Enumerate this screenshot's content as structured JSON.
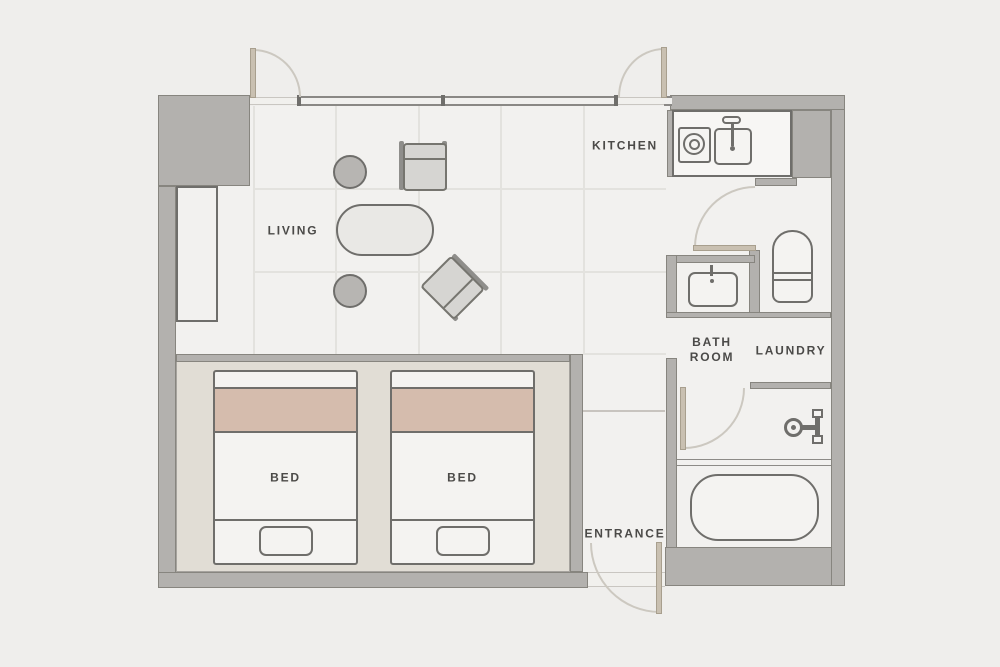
{
  "palette": {
    "background": "#efeeec",
    "floor": "#f2f1ef",
    "wall": "#b3b1ae",
    "wall_edge": "#87857f",
    "line_dark": "#6f6e6b",
    "bed_accent_pink": "#d5bcad",
    "bedroom_platform": "#e1ddd5",
    "door_leaf": "#c9c0b1",
    "swing_arc": "#ccc8c0",
    "label_text": "#4b4a48"
  },
  "rooms": {
    "living": {
      "label": "LIVING"
    },
    "kitchen": {
      "label": "KITCHEN"
    },
    "bathroom": {
      "label_line1": "BATH",
      "label_line2": "ROOM"
    },
    "laundry": {
      "label": "LAUNDRY"
    },
    "entrance": {
      "label": "ENTRANCE"
    },
    "bedroom": {
      "bed1_label": "BED",
      "bed2_label": "BED"
    }
  }
}
